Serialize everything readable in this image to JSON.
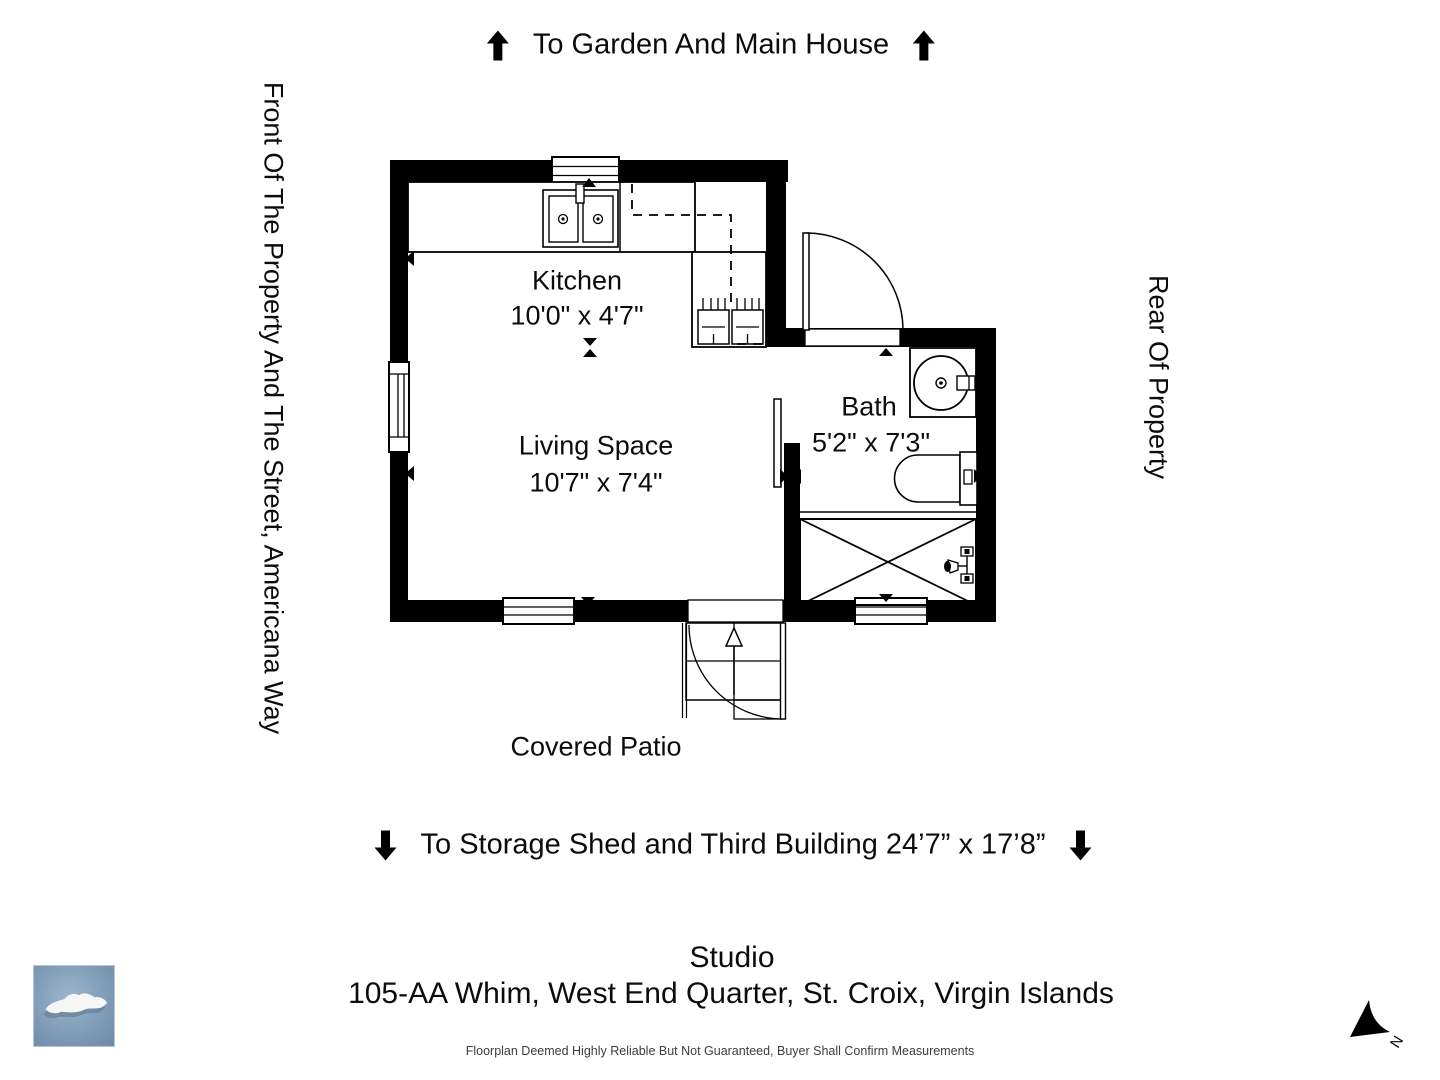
{
  "direction_labels": {
    "top": "To Garden And Main House",
    "bottom": "To Storage Shed and Third Building 24’7” x 17’8”",
    "left": "Front Of The Property And The Street, Americana Way",
    "right": "Rear Of Property"
  },
  "rooms": {
    "kitchen": {
      "name": "Kitchen",
      "dims": "10'0\" x 4'7\""
    },
    "living": {
      "name": "Living Space",
      "dims": "10'7\" x 7'4\""
    },
    "bath": {
      "name": "Bath",
      "dims": "5'2\" x 7'3\""
    },
    "patio": {
      "name": "Covered Patio"
    }
  },
  "footer": {
    "property_type": "Studio",
    "address": "105-AA Whim, West End Quarter, St. Croix, Virgin Islands",
    "disclaimer": "Floorplan Deemed Highly Reliable But Not Guaranteed, Buyer Shall Confirm Measurements"
  },
  "compass": {
    "north_label": "N"
  },
  "colors": {
    "line": "#000000",
    "island_bg": "#7e9ab5",
    "island_land": "#f6f6f4"
  }
}
